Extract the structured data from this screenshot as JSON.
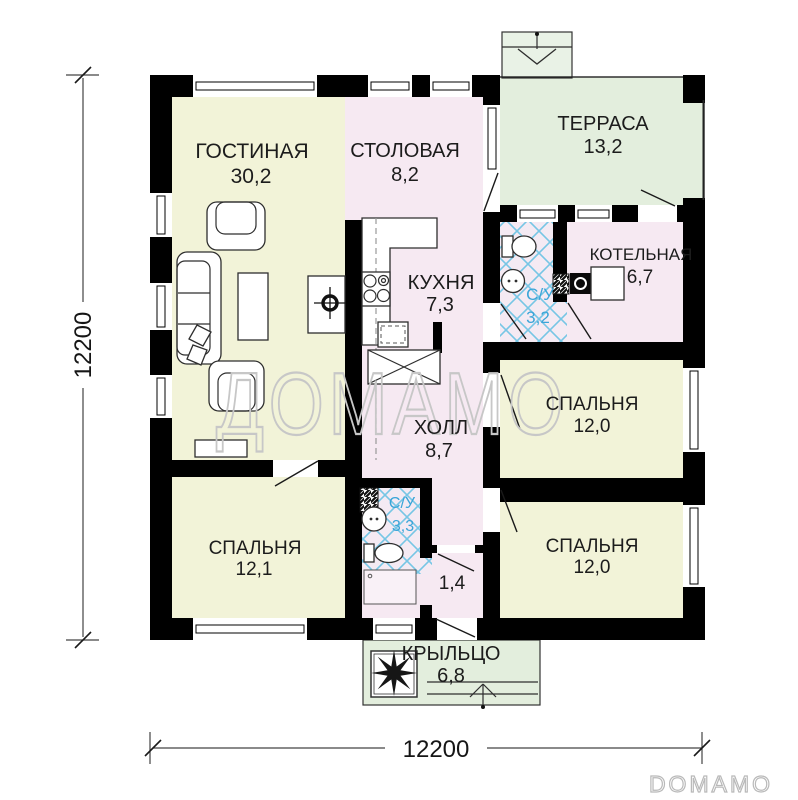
{
  "watermarks": {
    "center": "ДОМАМО",
    "corner": "DOMAMO"
  },
  "dimensions": {
    "width_bottom": "12200",
    "height_left": "12200"
  },
  "rooms": {
    "living": {
      "name": "ГОСТИНАЯ",
      "area": "30,2"
    },
    "dining": {
      "name": "СТОЛОВАЯ",
      "area": "8,2"
    },
    "terrace": {
      "name": "ТЕРРАСА",
      "area": "13,2"
    },
    "kitchen": {
      "name": "КУХНЯ",
      "area": "7,3"
    },
    "bath_top": {
      "name": "С/У",
      "area": "3,2"
    },
    "boiler": {
      "name": "КОТЕЛЬНАЯ",
      "area": "6,7"
    },
    "hall": {
      "name": "ХОЛЛ",
      "area": "8,7"
    },
    "bedroom_right_top": {
      "name": "СПАЛЬНЯ",
      "area": "12,0"
    },
    "bedroom_right_bottom": {
      "name": "СПАЛЬНЯ",
      "area": "12,0"
    },
    "bedroom_left": {
      "name": "СПАЛЬНЯ",
      "area": "12,1"
    },
    "bath_bottom": {
      "name": "С/У",
      "area": "3,3"
    },
    "vestibule": {
      "area": "1,4"
    },
    "porch": {
      "name": "КРЫЛЬЦО",
      "area": "6,8"
    }
  },
  "colors": {
    "room_cream": "#f2f3d8",
    "room_pink": "#f6e9f2",
    "room_green": "#e3eedd",
    "steps_green": "#e9f2e6",
    "tile_line": "#76c6e5",
    "wall": "#000000",
    "bath_text": "#3aa5d8",
    "watermark": "#c7c7c7"
  }
}
